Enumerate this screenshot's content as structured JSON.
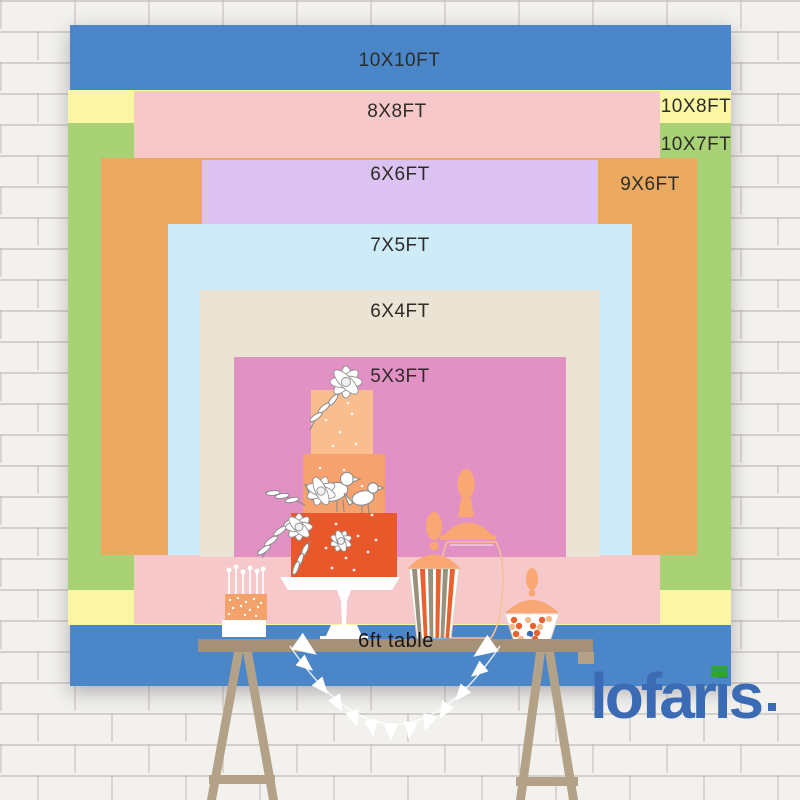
{
  "title": "Backdrop size comparison chart",
  "sizes": [
    {
      "label": "10X10FT",
      "color": "#4a86c8"
    },
    {
      "label": "8X8FT",
      "color": "#f6c8ca"
    },
    {
      "label": "10X8FT",
      "color": "#faf6a3"
    },
    {
      "label": "10X7FT",
      "color": "#a8d275"
    },
    {
      "label": "6X6FT",
      "color": "#dcc2f0"
    },
    {
      "label": "9X6FT",
      "color": "#ecaa60"
    },
    {
      "label": "7X5FT",
      "color": "#cdecf7"
    },
    {
      "label": "6X4FT",
      "color": "#ebe3d3"
    },
    {
      "label": "5X3FT",
      "color": "#e191c4"
    }
  ],
  "table": {
    "label": "6ft table",
    "surface_color": "#a69078",
    "leg_color": "#b3a287"
  },
  "brand": {
    "name": "lofaris",
    "color": "#3a6bb4",
    "accent_color": "#2fa43b"
  },
  "illustration": {
    "items": [
      "tiered-cake",
      "cake-stand",
      "cake-pops",
      "outline-candy-jar",
      "striped-popcorn-jar",
      "candy-bowl",
      "pennant-banner",
      "trestle-table"
    ],
    "colors": {
      "cake_top": "#f9bd8e",
      "cake_mid": "#f5a26e",
      "cake_bottom": "#e8582a",
      "stand": "#ffffff",
      "jar_lid": "#f9a873",
      "stripe_orange": "#e8612f",
      "stripe_gray": "#98917e",
      "candy_tan": "#f0bc8e",
      "pops_block": "#f4a26c",
      "banner": "#ffffff"
    }
  }
}
